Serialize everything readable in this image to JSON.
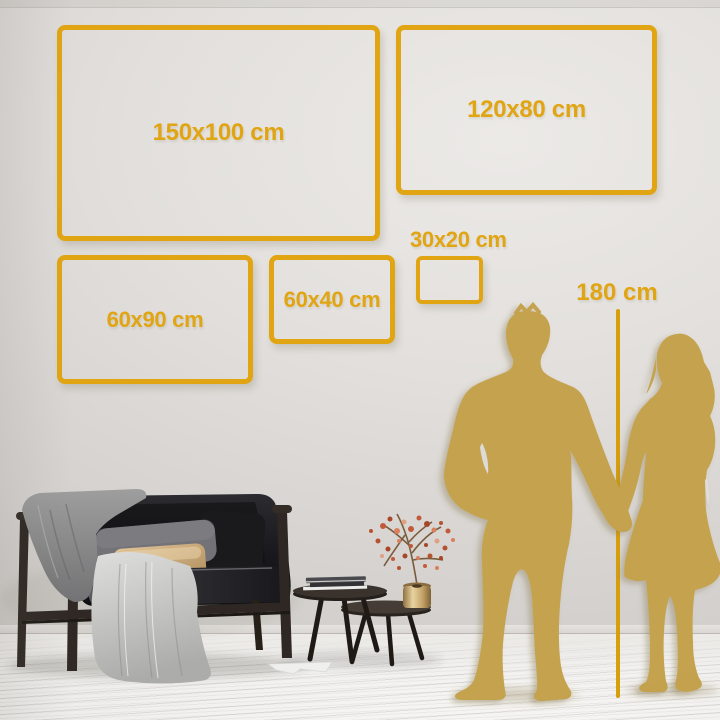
{
  "title": "Wall art size comparison guide",
  "colors": {
    "gold": "#E1A513",
    "gold_line": "#D89F0C",
    "silhouette_gold": "#C5A24E",
    "wall": "#DBD8D5",
    "floor": "#F2F1EF"
  },
  "frames": [
    {
      "label": "150x100 cm",
      "width_cm": 150,
      "height_cm": 100
    },
    {
      "label": "120x80 cm",
      "width_cm": 120,
      "height_cm": 80
    },
    {
      "label": "60x90 cm",
      "width_cm": 60,
      "height_cm": 90
    },
    {
      "label": "60x40 cm",
      "width_cm": 60,
      "height_cm": 40
    },
    {
      "label": "30x20 cm",
      "width_cm": 30,
      "height_cm": 20
    }
  ],
  "height_reference": {
    "label": "180 cm",
    "height_cm": 180
  },
  "scene": {
    "people": [
      "man-silhouette",
      "woman-silhouette"
    ],
    "furniture": [
      "sofa",
      "gray-blanket",
      "throw-blanket",
      "pillows",
      "coffee-table-large",
      "coffee-table-small",
      "books",
      "vase-with-branch"
    ]
  }
}
